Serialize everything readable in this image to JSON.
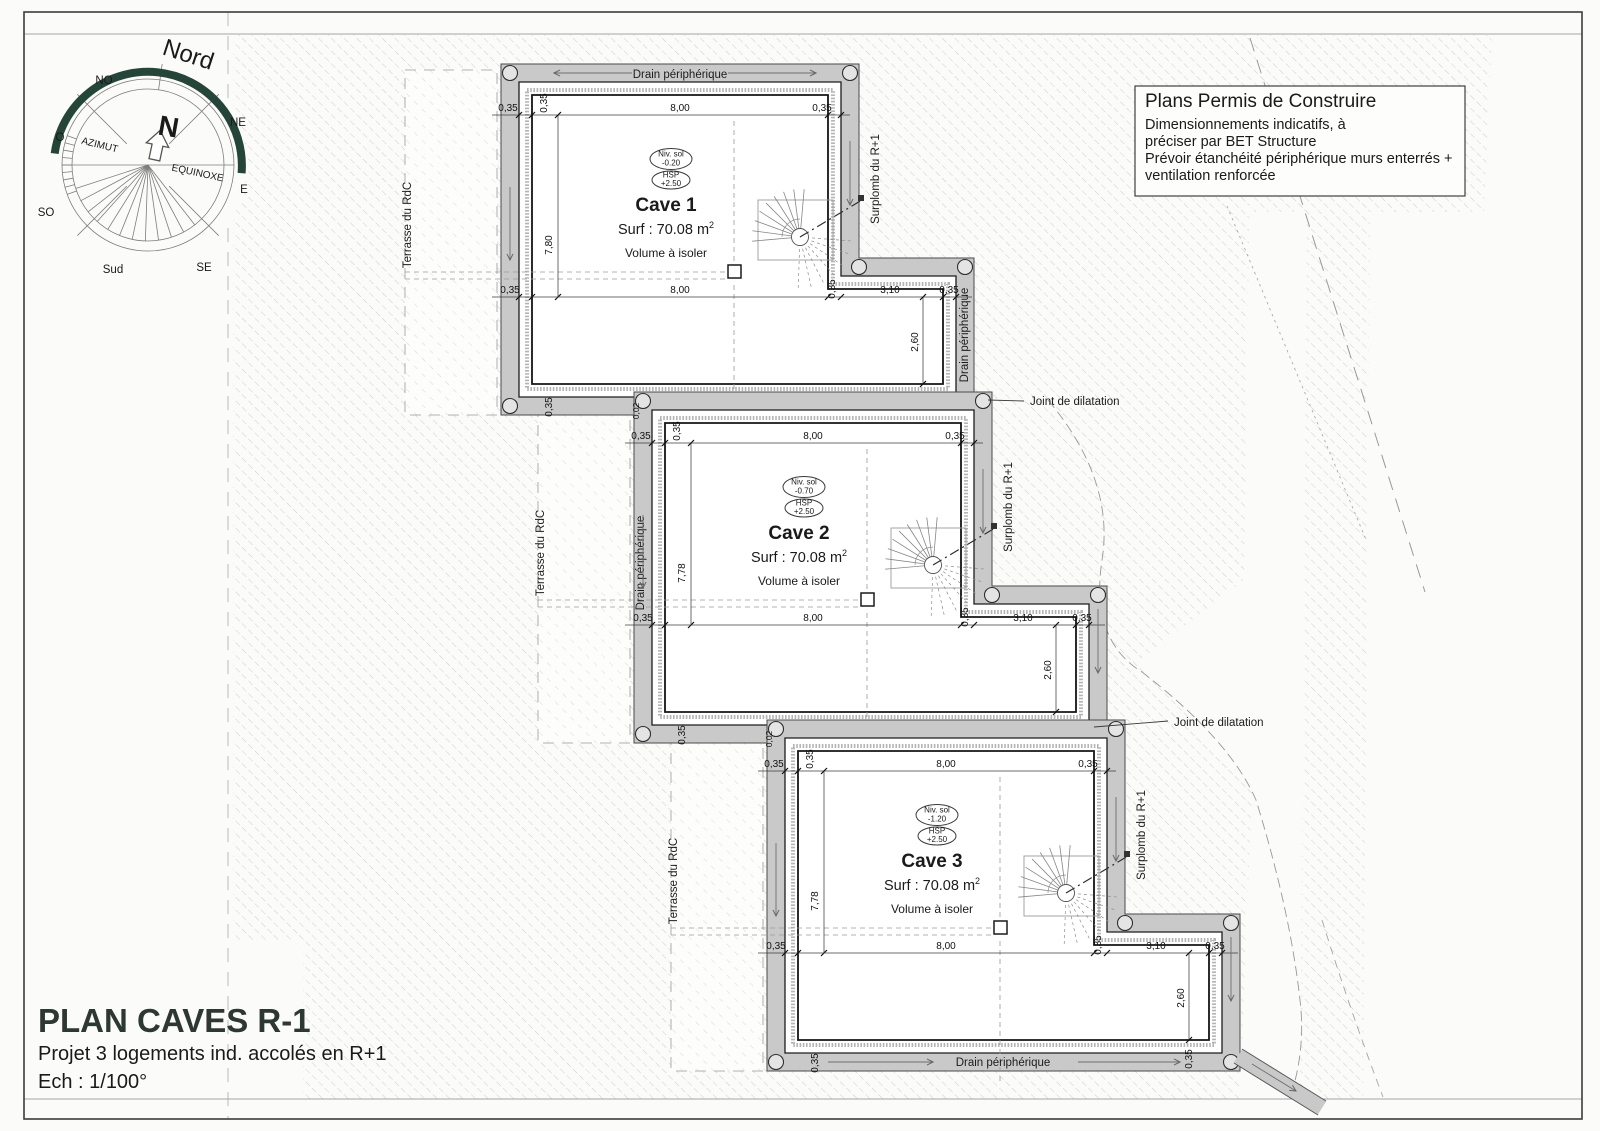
{
  "title_block": {
    "title": "PLAN CAVES R-1",
    "subtitle": "Projet 3 logements ind. accolés en R+1",
    "scale": "Ech : 1/100°"
  },
  "notes_box": {
    "title": "Plans Permis de Construire",
    "line1": "Dimensionnements indicatifs, à",
    "line2": "préciser par BET Structure",
    "line3": "Prévoir étanchéité périphérique murs enterrés +",
    "line4": "ventilation renforcée"
  },
  "compass": {
    "nord": "Nord",
    "n": "N",
    "no": "NO",
    "ne": "NE",
    "o": "O",
    "e": "E",
    "so": "SO",
    "se": "SE",
    "sud": "Sud",
    "azimut": "AZIMUT",
    "equinoxe": "EQUINOXE"
  },
  "annotations": {
    "drain": "Drain périphérique",
    "terrasse": "Terrasse du RdC",
    "surplomb": "Surplomb du R+1",
    "joint1": "Joint de dilatation",
    "joint2": "Joint de dilatation"
  },
  "dims": {
    "wall": "0,35",
    "joint": "0,02",
    "width": "8,00",
    "ext_width": "3,10",
    "ext_height": "2,60"
  },
  "caves": [
    {
      "name": "Cave 1",
      "surface": "Surf : 70.08 m",
      "surface_sup": "2",
      "volume": "Volume à isoler",
      "niv_label": "Niv. sol",
      "niv_value": "-0.20",
      "hsp_label": "HSP",
      "hsp_value": "+2.50",
      "height": "7,80"
    },
    {
      "name": "Cave 2",
      "surface": "Surf : 70.08 m",
      "surface_sup": "2",
      "volume": "Volume à isoler",
      "niv_label": "Niv. sol",
      "niv_value": "-0.70",
      "hsp_label": "HSP",
      "hsp_value": "+2.50",
      "height": "7,78"
    },
    {
      "name": "Cave 3",
      "surface": "Surf : 70.08 m",
      "surface_sup": "2",
      "volume": "Volume à isoler",
      "niv_label": "Niv. sol",
      "niv_value": "-1.20",
      "hsp_label": "HSP",
      "hsp_value": "+2.50",
      "height": "7,78"
    }
  ],
  "colors": {
    "wall_band": "#c9c9c9",
    "north_arc": "#26453a",
    "title": "#2e3833"
  }
}
